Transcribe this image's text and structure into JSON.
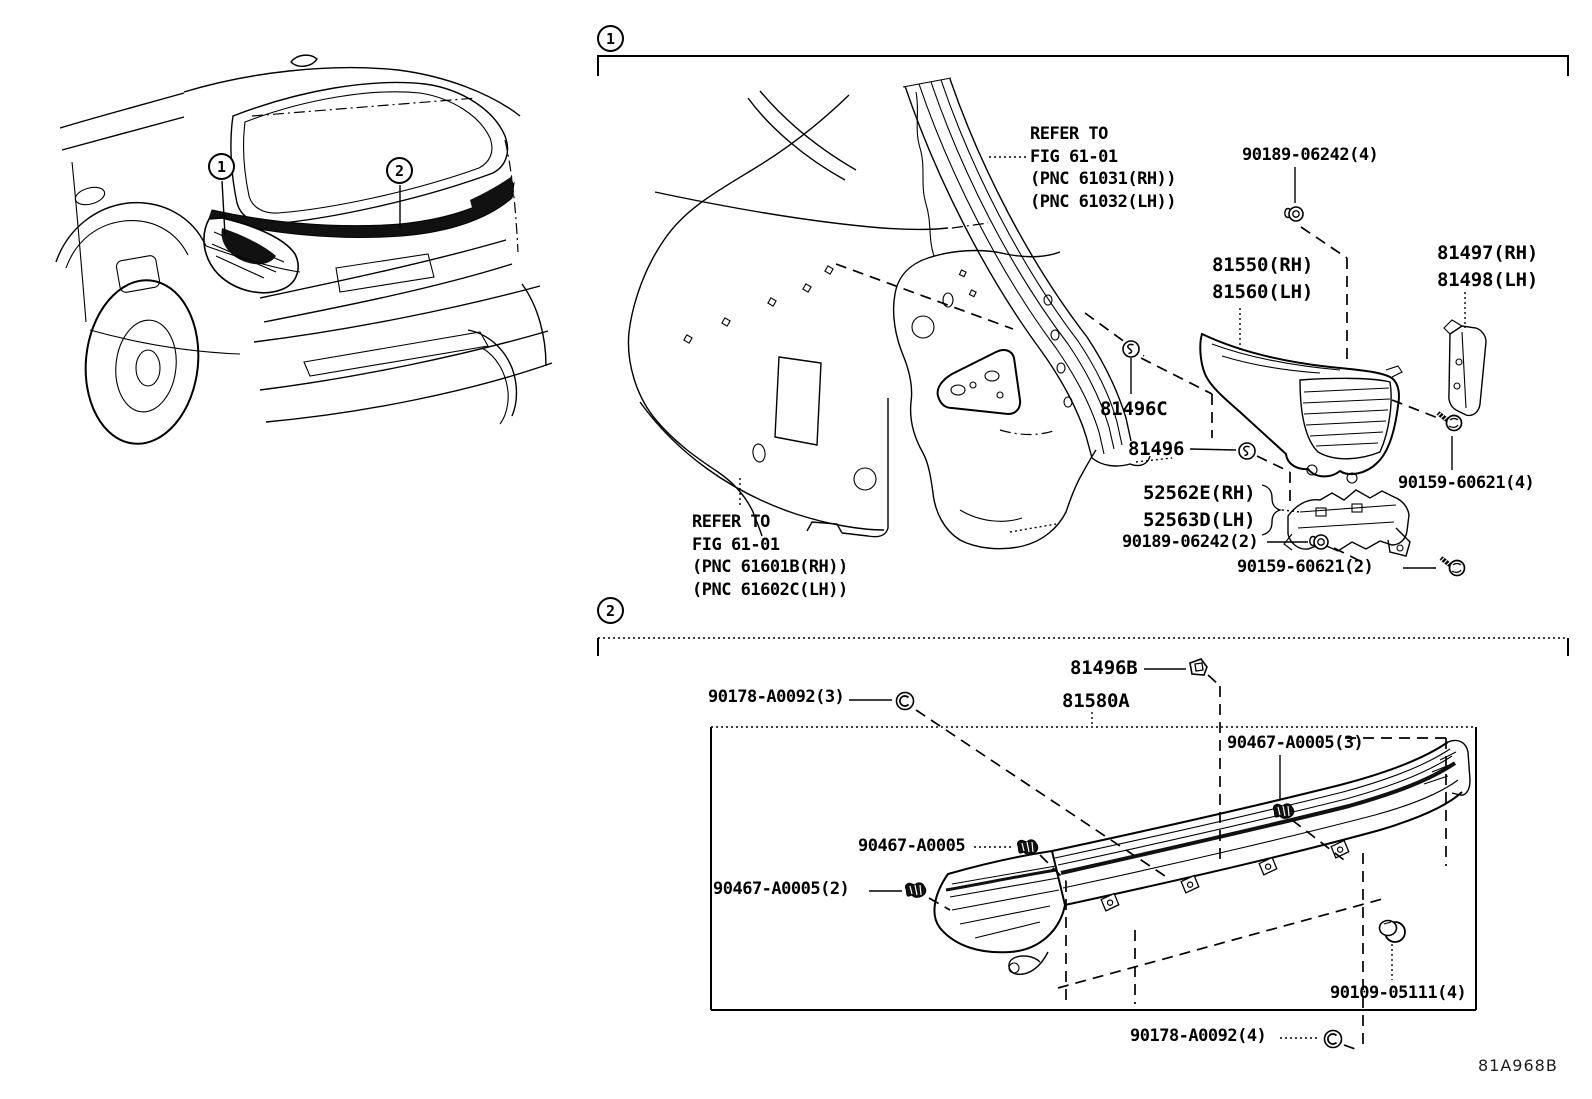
{
  "meta": {
    "footer_code": "81A968B"
  },
  "overview": {
    "callout1": "1",
    "callout2": "2"
  },
  "section1": {
    "badge": "1",
    "refer_upper": "REFER TO\nFIG 61-01\n(PNC 61031(RH))\n(PNC 61032(LH))",
    "refer_lower": "REFER TO\nFIG 61-01\n(PNC 61601B(RH))\n(PNC 61602C(LH))",
    "labels": {
      "screw_rear_4": "90189-06242(4)",
      "lamp_assy": "81550(RH)\n81560(LH)",
      "cover": "81497(RH)\n81498(LH)",
      "grommet_c": "81496C",
      "grommet": "81496",
      "bracket": "52562E(RH)\n52563D(LH)",
      "screw_rear_2": "90189-06242(2)",
      "screw_60621_2": "90159-60621(2)",
      "screw_60621_4": "90159-60621(4)"
    }
  },
  "section2": {
    "badge": "2",
    "labels": {
      "grommet_b": "81496B",
      "garnish": "81580A",
      "clip_a0092_3": "90178-A0092(3)",
      "clip_a0005_3": "90467-A0005(3)",
      "clip_a0005": "90467-A0005",
      "clip_a0005_2": "90467-A0005(2)",
      "bolt_05111_4": "90109-05111(4)",
      "clip_a0092_4": "90178-A0092(4)"
    }
  }
}
